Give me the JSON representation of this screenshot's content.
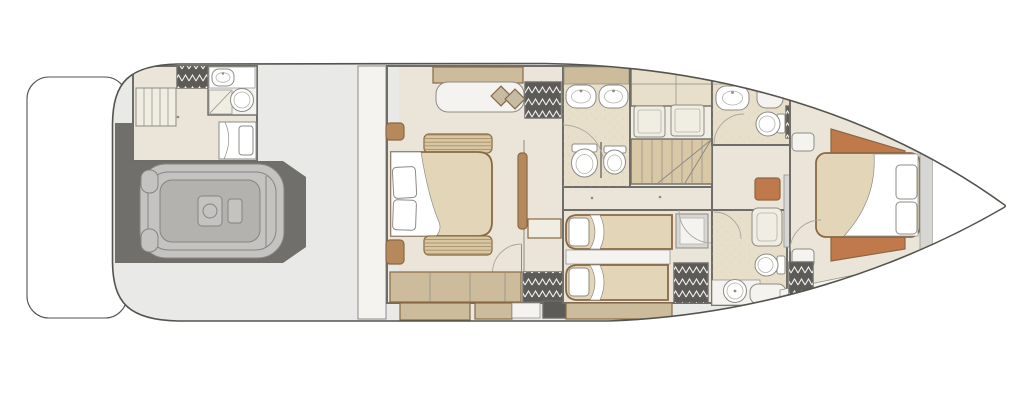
{
  "document": {
    "kind": "yacht-lower-deck-floor-plan",
    "visible_text": []
  },
  "colors": {
    "deck": "#e9e9e7",
    "hull": "#54534d",
    "wall": "#6e6d68",
    "line": "#8c8b85",
    "line2": "#b5b2a8",
    "floor": "#eae5d8",
    "floor2": "#f0ede3",
    "white2": "#f4f3ef",
    "tile": "#e7dfc9",
    "duvet": "#e2d5b8",
    "tan": "#cdbc9b",
    "slat": "#d8c7a2",
    "wood": "#8a6844",
    "wood2": "#b5895c",
    "terra": "#c0794a",
    "olive": "#a3a083",
    "dark": "#5c5b57",
    "garage": "#716f6c",
    "platform": "#d7d6d3",
    "tender": "#c4c3c1",
    "tender2": "#b3b2af",
    "tenderline": "#85847f",
    "stair": "#d9c8a6",
    "pillowtan": "#c6bca4",
    "arc": "#a9a79e"
  }
}
